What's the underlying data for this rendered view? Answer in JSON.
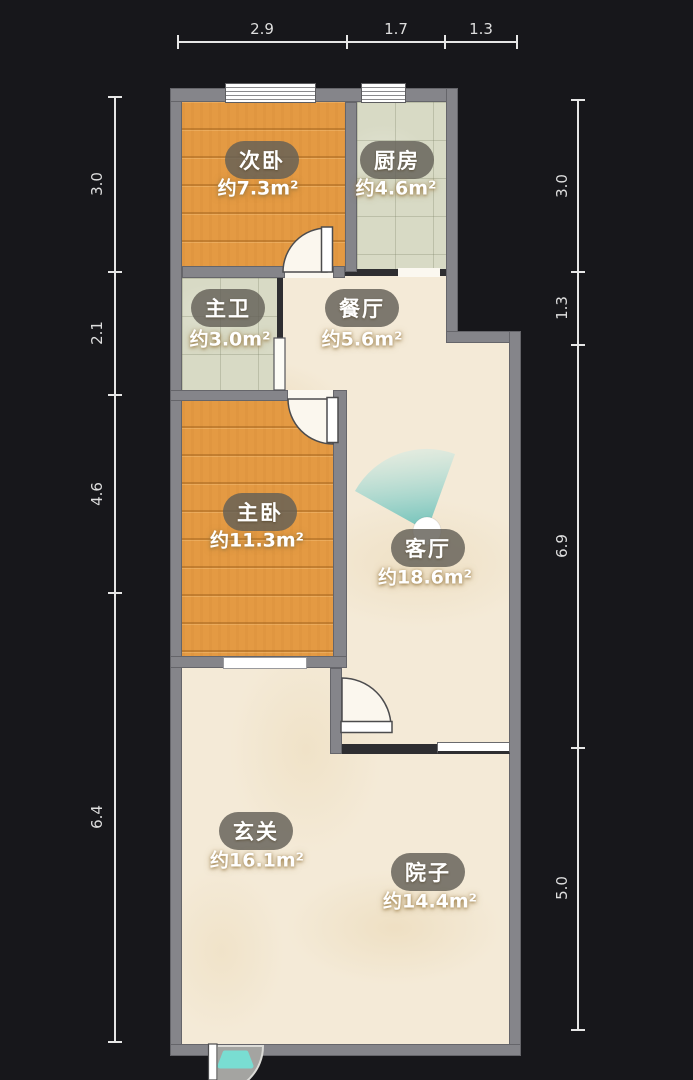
{
  "plan_title": "floor-plan",
  "rooms": [
    {
      "name": "次卧",
      "area": "约7.3m²"
    },
    {
      "name": "厨房",
      "area": "约4.6m²"
    },
    {
      "name": "主卫",
      "area": "约3.0m²"
    },
    {
      "name": "餐厅",
      "area": "约5.6m²"
    },
    {
      "name": "主卧",
      "area": "约11.3m²"
    },
    {
      "name": "客厅",
      "area": "约18.6m²"
    },
    {
      "name": "玄关",
      "area": "约16.1m²"
    },
    {
      "name": "院子",
      "area": "约14.4m²"
    }
  ],
  "dimensions": {
    "top": [
      "2.9",
      "1.7",
      "1.3"
    ],
    "left": [
      "3.0",
      "2.1",
      "4.6",
      "6.4"
    ],
    "right": [
      "3.0",
      "1.3",
      "6.9",
      "5.0"
    ]
  },
  "colors": {
    "background": "#17171b",
    "wall": "#85858a",
    "wood_floor": "#e49a43",
    "tile_floor": "#d8dac5",
    "marble_floor": "#f4ead7",
    "view_cone": "#5fbdb6",
    "entry_step": "#79ddd2"
  }
}
